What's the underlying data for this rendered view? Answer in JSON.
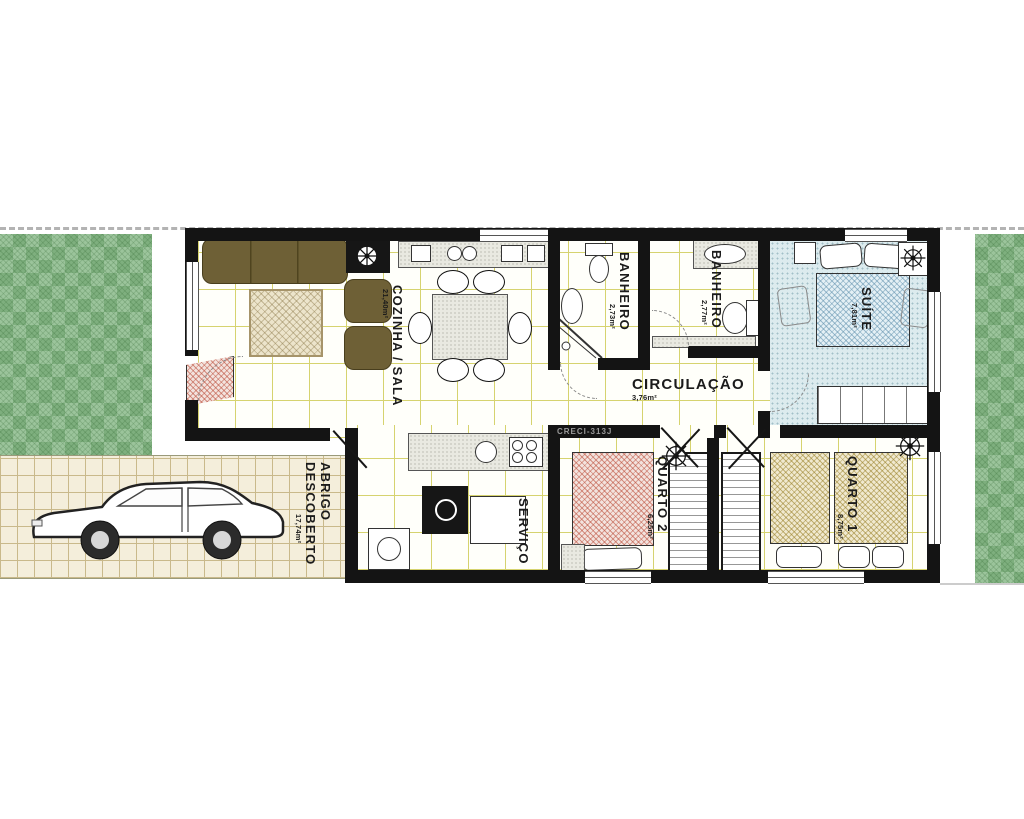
{
  "plan": {
    "watermark": "CRECI-313J",
    "rooms": {
      "cozinha_sala": {
        "label": "COZINHA / SALA",
        "area": "21,40m²"
      },
      "banheiro_1": {
        "label": "BANHEIRO",
        "area": "2,73m²"
      },
      "banheiro_2": {
        "label": "BANHEIRO",
        "area": "2,77m²"
      },
      "suite": {
        "label": "SUÍTE",
        "area": "7,81m²"
      },
      "circulacao": {
        "label": "CIRCULAÇÃO",
        "area": "3,76m²"
      },
      "quarto_2": {
        "label": "QUARTO 2",
        "area": "6,25m²"
      },
      "quarto_1": {
        "label": "QUARTO 1",
        "area": "8,75m²"
      },
      "servico": {
        "label": "SERVIÇO"
      },
      "abrigo": {
        "label_line_1": "ABRIGO",
        "label_line_2": "DESCOBERTO",
        "area": "17,74m²"
      }
    },
    "colors": {
      "grass": "#8cbb8c",
      "wall": "#141414",
      "tile-line": "#d6d36f",
      "paver-bg": "#f4eedb",
      "paver-line": "#c9b98b",
      "sofa": "#6e6036",
      "suite-floor": "#dcebee",
      "counter": "#e9e9e1"
    }
  }
}
